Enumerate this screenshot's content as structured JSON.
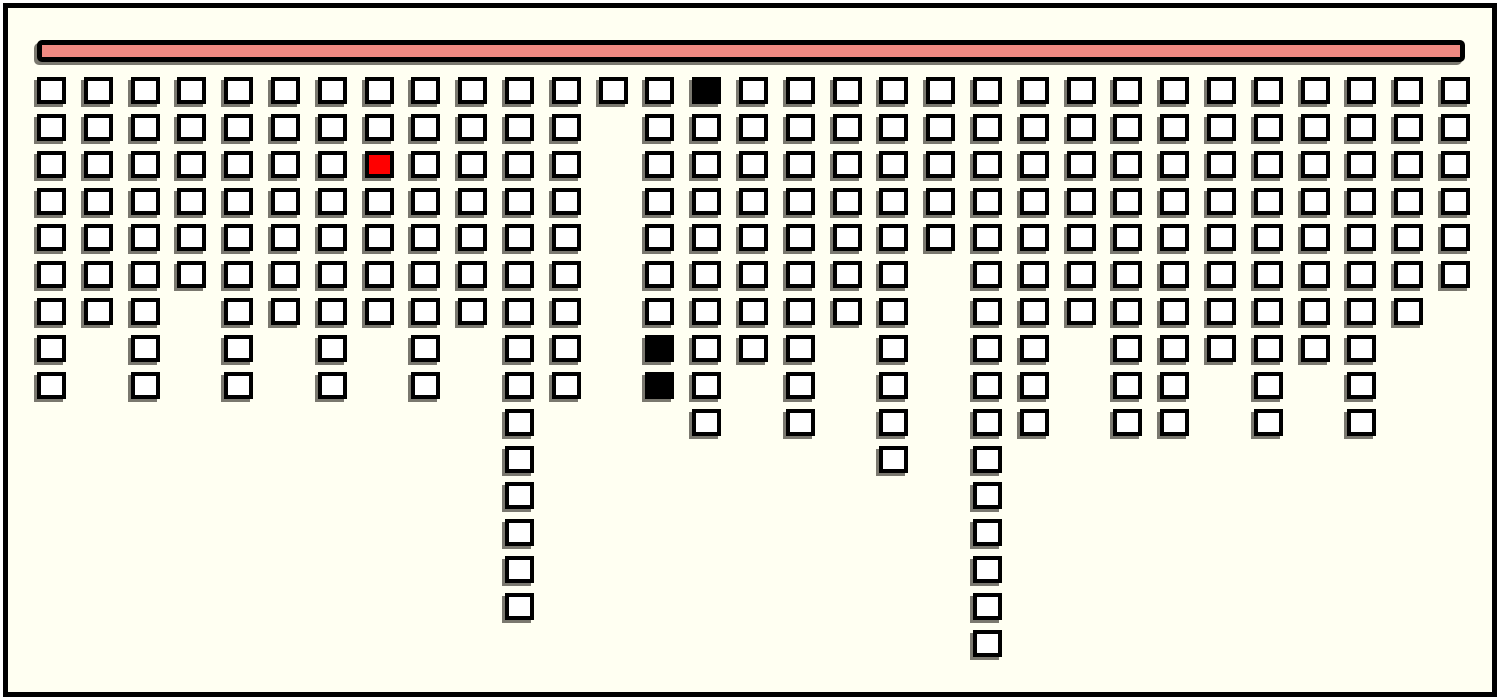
{
  "window": {
    "background_color": "#FFFFF2",
    "border_color": "#000000"
  },
  "top_bar": {
    "fill_color": "#F08A82",
    "border_color": "#000000"
  },
  "shadow_color": "#7A786F",
  "chart_data": {
    "type": "heatmap",
    "subtype": "icicle-unit-square-columns",
    "title": "",
    "description": "31 columns of unit squares hang downward from a horizontal salmon bar; each column has a different number of squares. Row 0 is directly under the bar.",
    "num_columns": 31,
    "max_rows": 16,
    "total_cells": 266,
    "column_heights": [
      9,
      7,
      9,
      6,
      9,
      7,
      9,
      7,
      9,
      7,
      15,
      9,
      1,
      9,
      10,
      8,
      10,
      7,
      11,
      5,
      16,
      10,
      7,
      10,
      10,
      8,
      10,
      8,
      10,
      7,
      6
    ],
    "cell_default_color": "#FFFFFF",
    "cell_border_color": "#000000",
    "special_cells": [
      {
        "col": 7,
        "row": 2,
        "color": "#FF0000",
        "name": "red-cell"
      },
      {
        "col": 14,
        "row": 0,
        "color": "#000000",
        "name": "black-cell"
      },
      {
        "col": 13,
        "row": 7,
        "color": "#000000",
        "name": "black-cell"
      },
      {
        "col": 13,
        "row": 8,
        "color": "#000000",
        "name": "black-cell"
      }
    ],
    "legend": [],
    "axis_labels": {
      "x": "",
      "y": ""
    },
    "grid": "off"
  }
}
